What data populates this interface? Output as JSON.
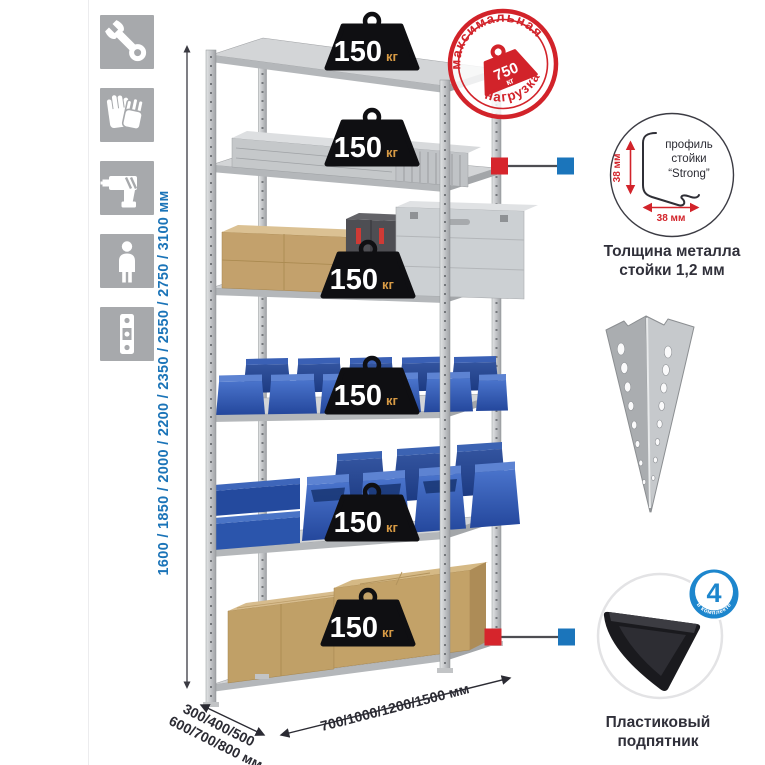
{
  "colors": {
    "accent_blue": "#1b75bb",
    "accent_red": "#d6252c",
    "stamp_red": "#d2232a",
    "icon_grey": "#a7a9ac",
    "bin_blue": "#2e59b0",
    "text_dark": "#2b2b33"
  },
  "left_icons": [
    {
      "name": "wrench-icon"
    },
    {
      "name": "gloves-icon"
    },
    {
      "name": "drill-icon"
    },
    {
      "name": "person-icon"
    },
    {
      "name": "level-icon"
    }
  ],
  "height_dimension": {
    "label": "1600 / 1850 / 2000 / 2200 / 2350 / 2550 / 2750 / 3100 мм"
  },
  "rack": {
    "shelf_loads": [
      {
        "value": "150",
        "unit": "кг"
      },
      {
        "value": "150",
        "unit": "кг"
      },
      {
        "value": "150",
        "unit": "кг"
      },
      {
        "value": "150",
        "unit": "кг"
      },
      {
        "value": "150",
        "unit": "кг"
      },
      {
        "value": "150",
        "unit": "кг"
      }
    ]
  },
  "max_load_stamp": {
    "arc_top": "максимальная",
    "arc_bottom": "нагрузка",
    "value": "750",
    "unit": "кг"
  },
  "profile_detail": {
    "label_line1": "профиль",
    "label_line2": "стойки",
    "label_line3": "“Strong”",
    "dim_vertical": "38 мм",
    "dim_horizontal": "38 мм",
    "caption_line1": "Толщина металла",
    "caption_line2": "стойки 1,2 мм"
  },
  "foot_detail": {
    "badge_value": "4",
    "badge_arc": "в комплекте",
    "caption_line1": "Пластиковый",
    "caption_line2": "подпятник"
  },
  "base_dimensions": {
    "depth_line1": "300/400/500",
    "depth_line2": "600/700/800 мм",
    "width": "700/1000/1200/1500 мм"
  }
}
